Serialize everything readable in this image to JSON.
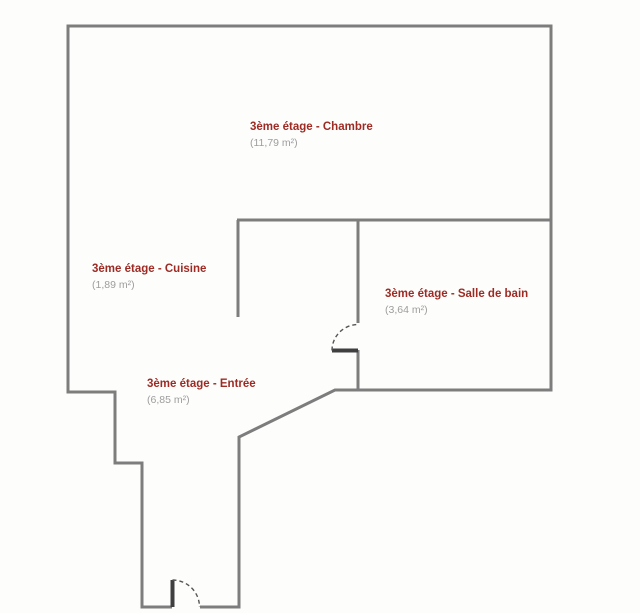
{
  "floorplan": {
    "rooms": [
      {
        "id": "chambre",
        "name": "3ème étage - Chambre",
        "area": "(11,79 m²)"
      },
      {
        "id": "cuisine",
        "name": "3ème étage - Cuisine",
        "area": "(1,89 m²)"
      },
      {
        "id": "salle-de-bain",
        "name": "3ème étage - Salle de bain",
        "area": "(3,64 m²)"
      },
      {
        "id": "entree",
        "name": "3ème étage - Entrée",
        "area": "(6,85 m²)"
      }
    ],
    "colors": {
      "wall": "#7d7d7d",
      "door": "#3f3f3f",
      "swing": "#555555",
      "room_name": "#9d2b24",
      "room_area": "#9d9d9d",
      "background": "#fdfdfc"
    }
  }
}
